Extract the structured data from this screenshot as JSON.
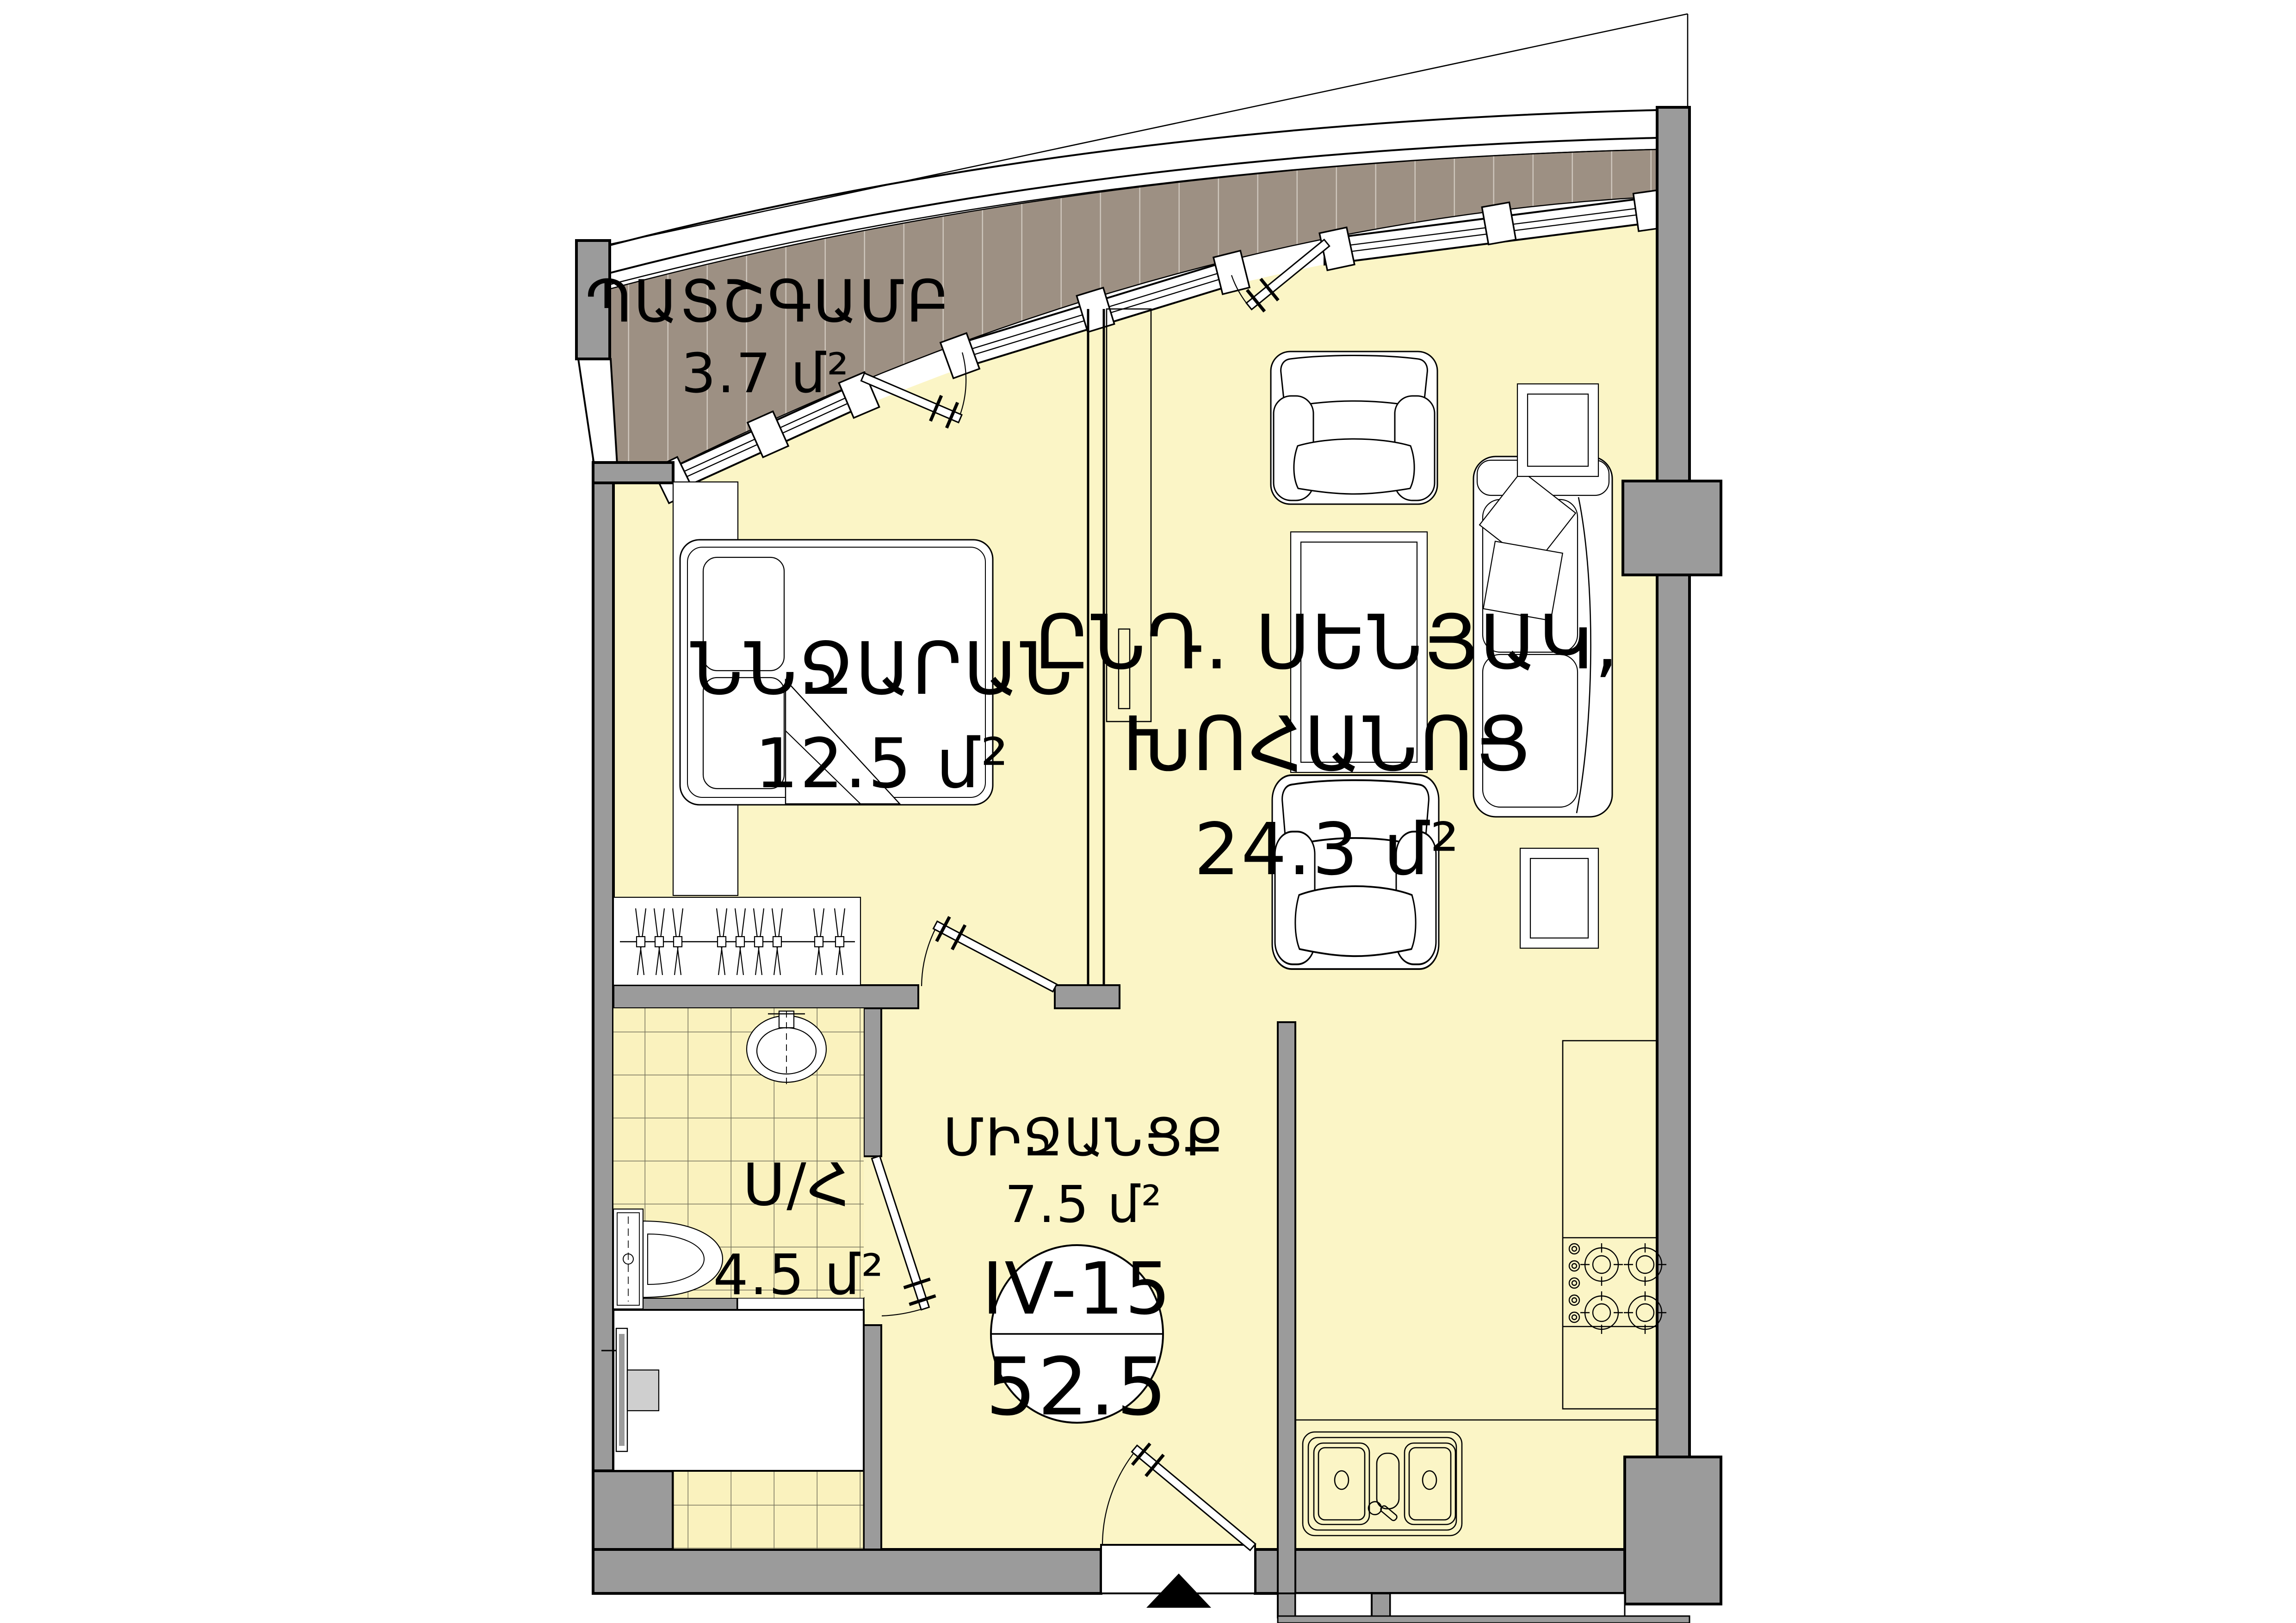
{
  "unit_badge": {
    "unit_number": "IV-15",
    "total_area": "52.5"
  },
  "rooms": {
    "balcony": {
      "name": "ՊԱՏՇԳԱՄԲ",
      "area": "3.7 մ²"
    },
    "bedroom": {
      "name": "ՆՆՋԱՐԱՆ",
      "area": "12.5 մ²"
    },
    "living": {
      "name_line1": "ԸՆԴ. ՍԵՆՅԱԿ,",
      "name_line2": "ԽՈՀԱՆՈՑ",
      "area": "24.3 մ²"
    },
    "corridor": {
      "name": "ՄԻՋԱՆՑՔ",
      "area": "7.5 մ²"
    },
    "bathroom": {
      "name": "Ս/Հ",
      "area": "4.5 մ²"
    }
  },
  "colors": {
    "floor": "#FBF5C6",
    "wall_gray": "#9B9B9B",
    "balcony_deck": "#9D9083",
    "tile_floor": "#FAF2BE",
    "outline": "#000000",
    "appliance_gray": "#CFCFCF",
    "background": "#FFFFFF"
  }
}
